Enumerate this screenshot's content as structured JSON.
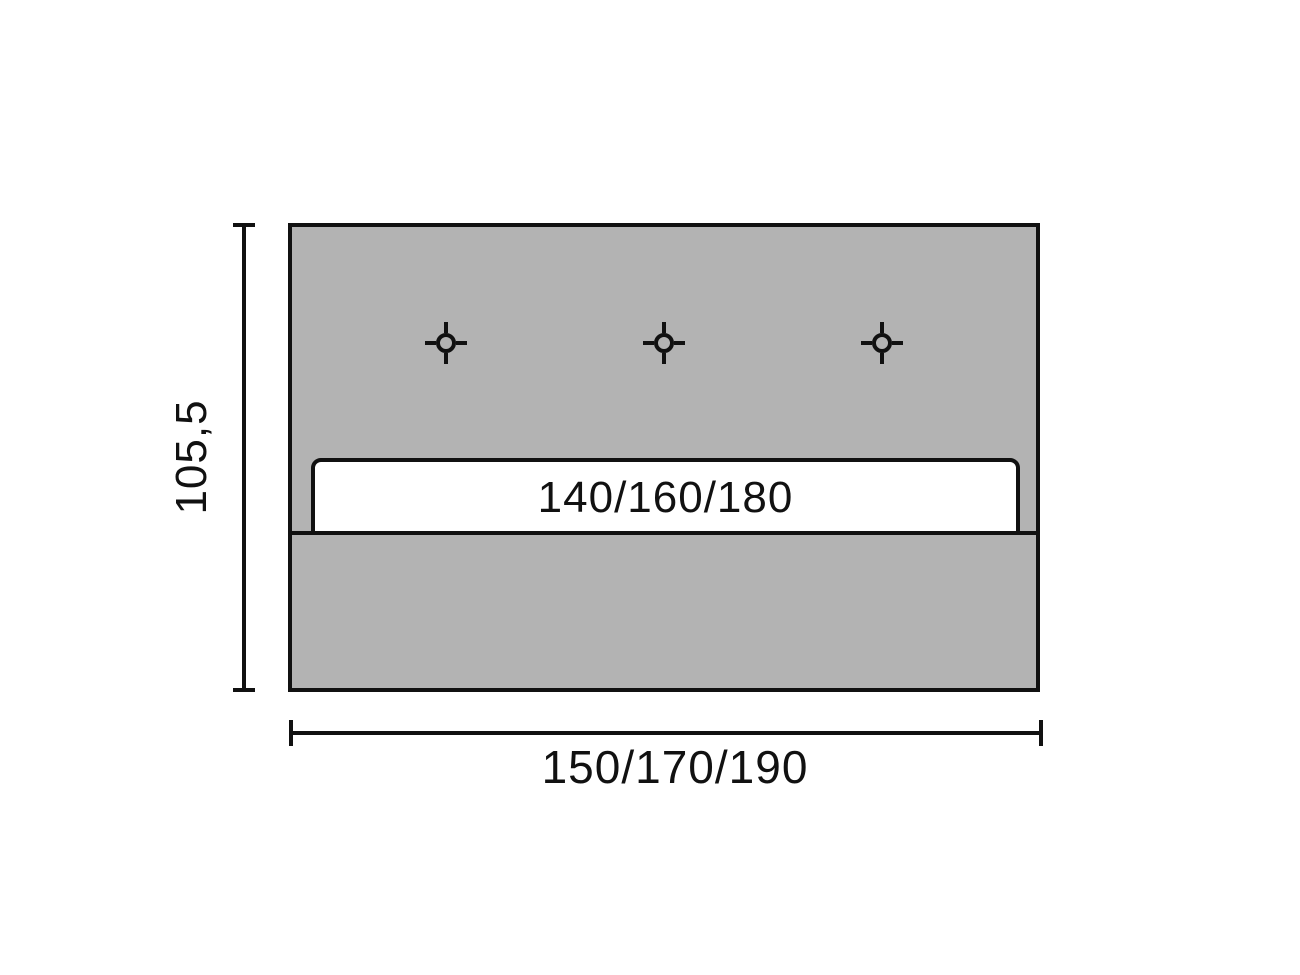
{
  "diagram": {
    "type": "furniture-dimension-drawing",
    "panel": {
      "slot_label": "140/160/180",
      "mount_markers": [
        {
          "icon": "crosshair-drill-mark-icon"
        },
        {
          "icon": "crosshair-drill-mark-icon"
        },
        {
          "icon": "crosshair-drill-mark-icon"
        }
      ]
    },
    "dimensions": {
      "height_label": "105,5",
      "width_label": "150/170/190"
    }
  },
  "colors": {
    "panel_fill": "#b3b3b3",
    "bar_fill": "#ffffff",
    "line": "#111111",
    "background": "#ffffff"
  }
}
